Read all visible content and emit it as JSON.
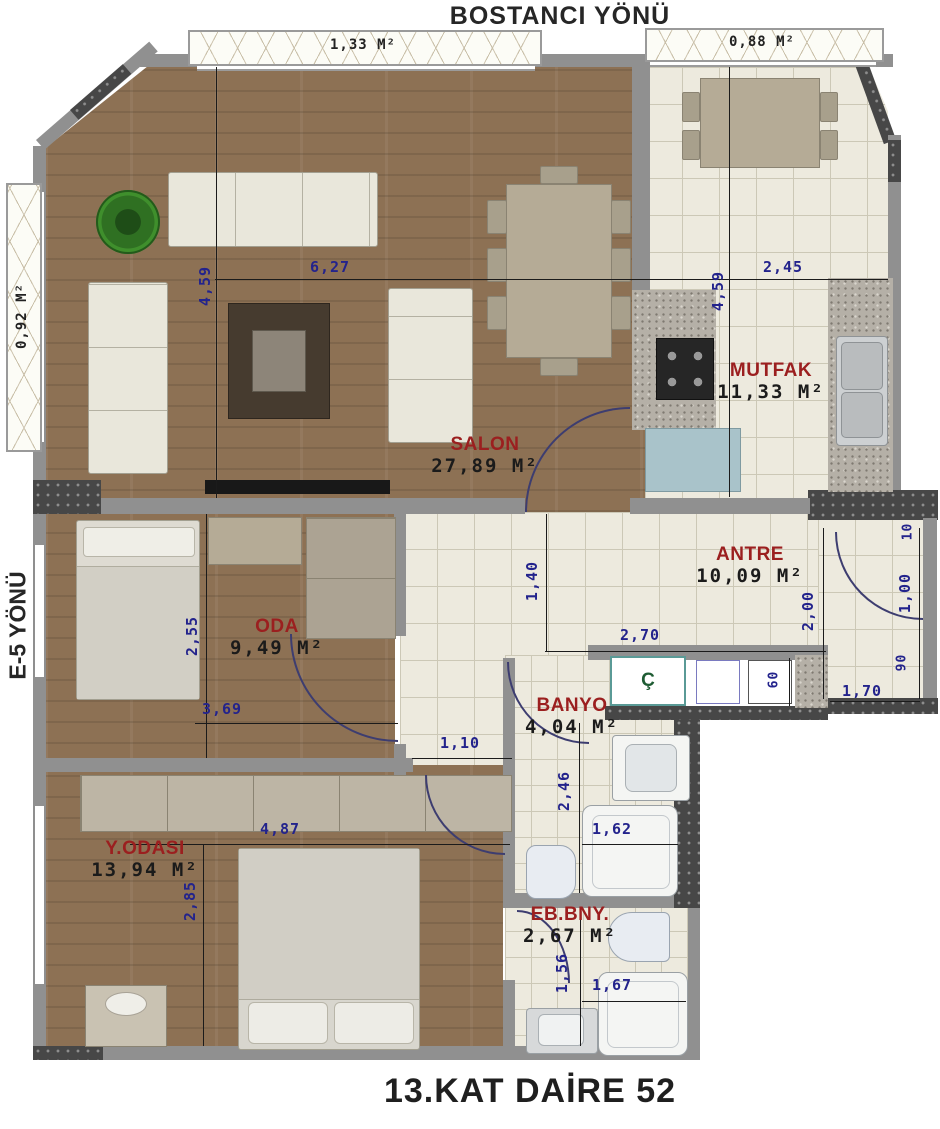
{
  "titles": {
    "top": "BOSTANCI YÖNÜ",
    "left": "E-5 YÖNÜ",
    "bottom": "13.KAT DAİRE 52"
  },
  "rooms": {
    "salon": {
      "name": "SALON",
      "area": "27,89 M²"
    },
    "mutfak": {
      "name": "MUTFAK",
      "area": "11,33 M²"
    },
    "antre": {
      "name": "ANTRE",
      "area": "10,09 M²"
    },
    "oda": {
      "name": "ODA",
      "area": "9,49 M²"
    },
    "banyo": {
      "name": "BANYO",
      "area": "4,04 M²"
    },
    "yodasi": {
      "name": "Y.ODASI",
      "area": "13,94 M²"
    },
    "ebbny": {
      "name": "EB.BNY.",
      "area": "2,67 M²"
    },
    "shaft": {
      "name": "Ç"
    }
  },
  "balconies": {
    "top_left": "1,33 M²",
    "top_right": "0,88 M²",
    "left": "0,92 M²"
  },
  "dimensions": {
    "salon_w": "6,27",
    "salon_h": "4,59",
    "mutfak_w": "2,45",
    "mutfak_h": "4,59",
    "antre_depth": "1,40",
    "antre_w": "2,70",
    "oda_h": "2,55",
    "oda_w": "3,69",
    "corridor_w": "1,10",
    "yodasi_w": "4,87",
    "yodasi_h": "2,85",
    "banyo_h": "2,46",
    "banyo_shower_w": "1,62",
    "ebbny_h": "1,56",
    "ebbny_shower_w": "1,67",
    "entry_h": "2,00",
    "entry_w": "1,70",
    "entry_right_h": "1,00",
    "entry_top": "10",
    "entry_bottom": "90",
    "shaft_h": "60"
  },
  "colors": {
    "room_label": "#9b1f1f",
    "dimension": "#23238c",
    "wood": "#8d7154",
    "tile": "#edeade",
    "wall": "#909090",
    "structure": "#474747"
  }
}
